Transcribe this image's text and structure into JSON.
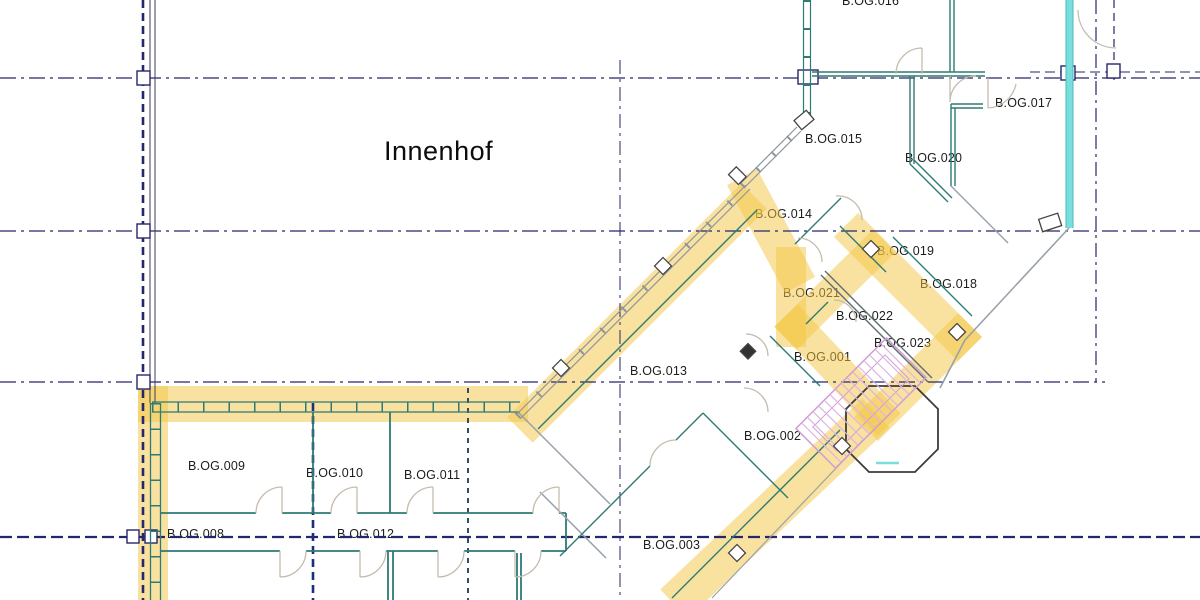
{
  "plan": {
    "courtyard_label": "Innenhof",
    "rooms": {
      "b016": "B.OG.016",
      "b017": "B.OG.017",
      "b015": "B.OG.015",
      "b020": "B.OG.020",
      "b014": "B.OG.014",
      "b019": "B.OG.019",
      "b018": "B.OG.018",
      "b021": "B.OG.021",
      "b022": "B.OG.022",
      "b023": "B.OG.023",
      "b001": "B.OG.001",
      "b013": "B.OG.013",
      "b002": "B.OG.002",
      "b003": "B.OG.003",
      "b009": "B.OG.009",
      "b010": "B.OG.010",
      "b011": "B.OG.011",
      "b008": "B.OG.008",
      "b012": "B.OG.012"
    },
    "colors": {
      "route_highlight_yellow": "#F4C642",
      "wall_teal": "#2E7A74",
      "wall_gray": "#98A1A9",
      "grid_navy": "#26266B",
      "accent_cyan": "#79DEDE",
      "stair_hatch_pink": "#D4A2DA",
      "door_arc_tan": "#C6BCAE",
      "label_text": "#1C1C1C"
    }
  }
}
